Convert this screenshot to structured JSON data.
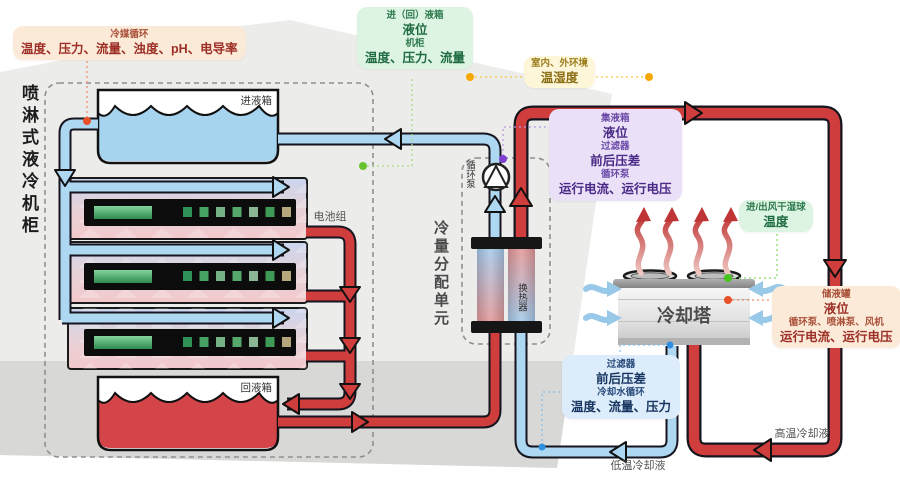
{
  "title": "喷淋式液冷机柜监测系统图",
  "cabinet": {
    "label": "喷淋式液冷机柜"
  },
  "components": {
    "inlet_tank": "进液箱",
    "return_tank": "回液箱",
    "battery_group": "电池组",
    "cdu": "冷量分配单元",
    "pump": "循环泵",
    "heat_exchanger": "换热器",
    "cooling_tower": "冷却塔"
  },
  "flow_labels": {
    "high_temp": "高温冷却液",
    "low_temp": "低温冷却液"
  },
  "callouts": {
    "refrigerant_loop": {
      "title": "冷媒循环",
      "metrics": "温度、压力、流量、浊度、pH、电导率"
    },
    "tank_cabinet": {
      "t1": "进（回）液箱",
      "v1": "液位",
      "t2": "机柜",
      "v2": "温度、压力、流量"
    },
    "environment": {
      "t1": "室内、外环境",
      "v1": "温湿度"
    },
    "collector": {
      "t1": "集液箱",
      "v1": "液位",
      "t2": "过滤器",
      "v2": "前后压差",
      "t3": "循环泵",
      "v3": "运行电流、运行电压"
    },
    "wet_bulb": {
      "t1": "进/出风干湿球",
      "v1": "温度"
    },
    "storage": {
      "t1": "储液罐",
      "v1": "液位",
      "t2": "循环泵、喷淋泵、风机",
      "v2": "运行电流、运行电压"
    },
    "cooling_water": {
      "t1": "过滤器",
      "v1": "前后压差",
      "t2": "冷却水循环",
      "v2": "温度、流量、压力"
    }
  },
  "colors": {
    "hot_pipe": "#cf3d3d",
    "cold_pipe": "#aed7f2",
    "pipe_outline": "#15151f",
    "building_bg": "#ececeb",
    "floor_bg": "#d8d8d6",
    "callout_peach": "#fcead9",
    "callout_green": "#ddf4e3",
    "callout_yellow": "#fdf6d8",
    "callout_purple": "#eae1f8",
    "callout_blue": "#dcecfb",
    "sensor_dot_orange": "#e8502a",
    "sensor_dot_green": "#5cc52e",
    "sensor_dot_amber": "#f5a800",
    "sensor_dot_purple": "#7d3fd0",
    "sensor_dot_blue": "#2f8fe0"
  }
}
